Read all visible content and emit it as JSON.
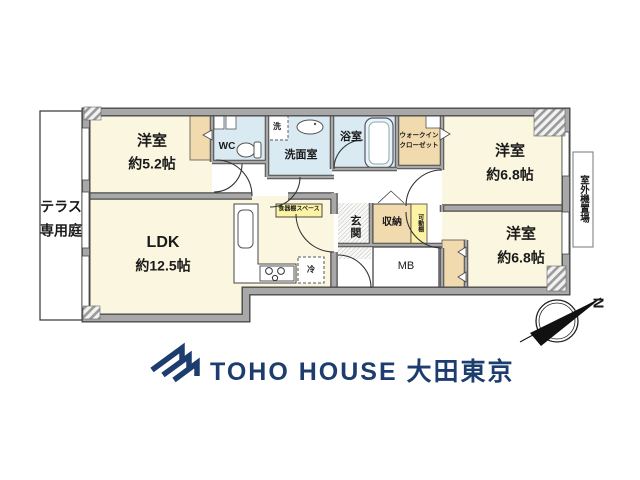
{
  "plan": {
    "terrace": {
      "line1": "テラス",
      "line2": "専用庭"
    },
    "rooms": {
      "bedroom1": {
        "name": "洋室",
        "size": "約5.2帖"
      },
      "ldk": {
        "name": "LDK",
        "size": "約12.5帖"
      },
      "bedroom2": {
        "name": "洋室",
        "size": "約6.8帖"
      },
      "bedroom3": {
        "name": "洋室",
        "size": "約6.8帖"
      }
    },
    "labels": {
      "wc": "WC",
      "washer": "洗",
      "washroom": "洗面室",
      "bath": "浴室",
      "wic_line1": "ウォークイン",
      "wic_line2": "クローゼット",
      "genkan": "玄関",
      "storage": "収納",
      "movable_shelf": "可動棚",
      "mb": "MB",
      "dish_space": "食器棚スペース",
      "fridge": "冷",
      "outdoor_unit": "室外機置場",
      "compass_north": "N"
    },
    "colors": {
      "room": "#FBF6DF",
      "wet": "#D9EAF3",
      "closet": "#F0DAAE",
      "label_bg": "#FDF3A5",
      "wall": "#A8A8A8",
      "brand_navy": "#1C3D6D"
    }
  },
  "footer": {
    "brand": "TOHO HOUSE 大田東京"
  }
}
